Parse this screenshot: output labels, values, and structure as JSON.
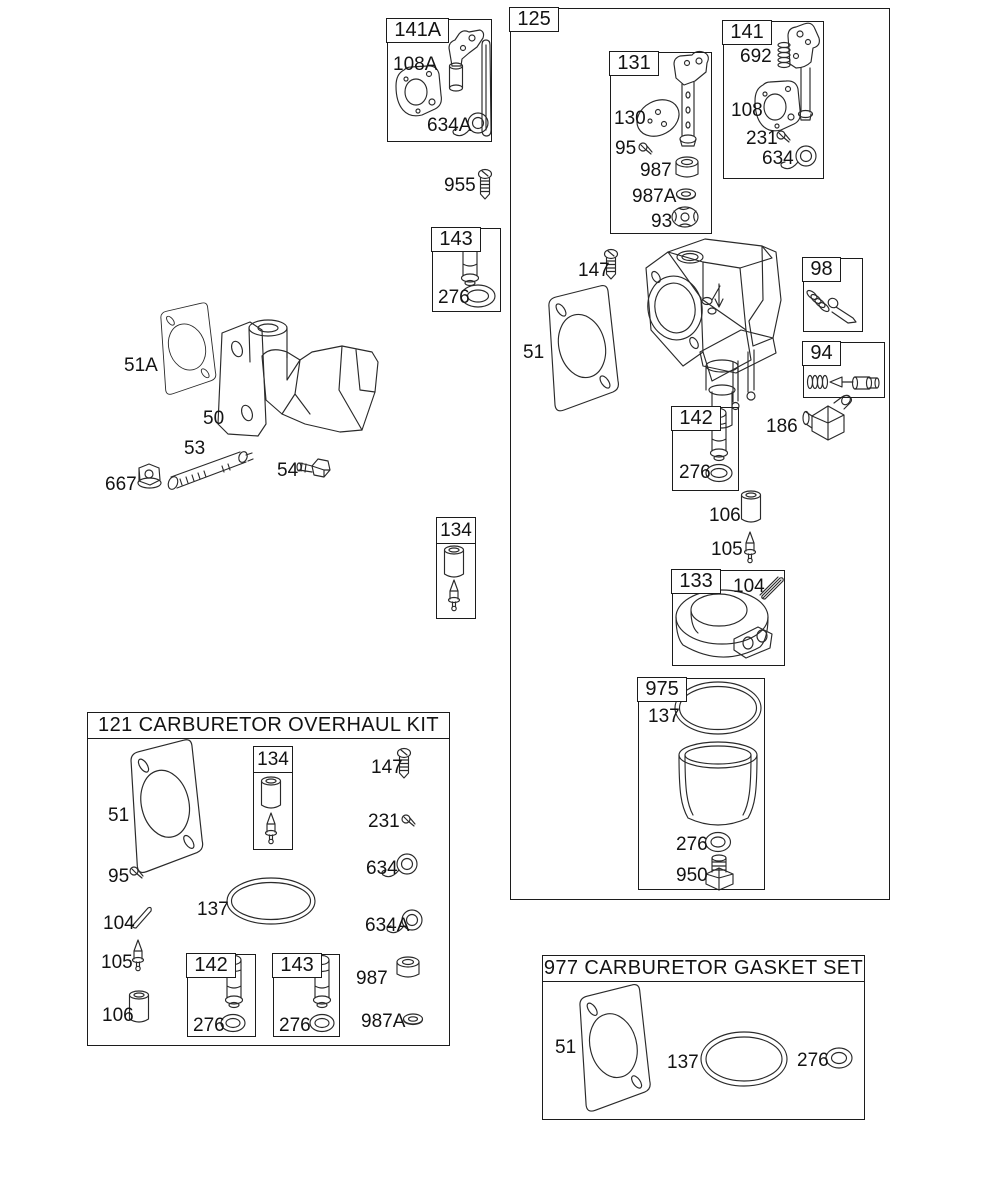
{
  "colors": {
    "background": "#ffffff",
    "line": "#2a2a2a",
    "text": "#131313"
  },
  "boxes": {
    "box141A": {
      "title": "141A",
      "labels": {
        "p108A": "108A",
        "p634A": "634A"
      }
    },
    "box143top": {
      "title": "143",
      "labels": {
        "p276": "276"
      }
    },
    "box125": {
      "title": "125",
      "labels": {
        "p147": "147",
        "p51": "51",
        "p186": "186",
        "p106": "106",
        "p105": "105"
      }
    },
    "box131": {
      "title": "131",
      "labels": {
        "p130": "130",
        "p95": "95",
        "p987": "987",
        "p987A": "987A",
        "p93": "93"
      }
    },
    "box141": {
      "title": "141",
      "labels": {
        "p692": "692",
        "p108": "108",
        "p231": "231",
        "p634": "634"
      }
    },
    "box98": {
      "title": "98"
    },
    "box94": {
      "title": "94"
    },
    "box142": {
      "title": "142",
      "labels": {
        "p276": "276"
      }
    },
    "box133": {
      "title": "133",
      "labels": {
        "p104": "104"
      }
    },
    "box975": {
      "title": "975",
      "labels": {
        "p137": "137",
        "p276": "276",
        "p950": "950"
      }
    },
    "box134mid": {
      "title": "134"
    },
    "overhaulKit": {
      "title": "121 CARBURETOR OVERHAUL KIT",
      "labels": {
        "p51": "51",
        "p95": "95",
        "p147": "147",
        "p231": "231",
        "p634": "634",
        "p104": "104",
        "p137": "137",
        "p634A": "634A",
        "p105": "105",
        "p106": "106",
        "p987": "987",
        "p987A": "987A"
      },
      "box134": {
        "title": "134"
      },
      "box142": {
        "title": "142",
        "labels": {
          "p276": "276"
        }
      },
      "box143": {
        "title": "143",
        "labels": {
          "p276": "276"
        }
      }
    },
    "gasketSet": {
      "title": "977 CARBURETOR GASKET SET",
      "labels": {
        "p51": "51",
        "p137": "137",
        "p276": "276"
      }
    }
  },
  "freeLabels": {
    "p955": "955",
    "p51A": "51A",
    "p50": "50",
    "p53": "53",
    "p54": "54",
    "p667": "667"
  }
}
